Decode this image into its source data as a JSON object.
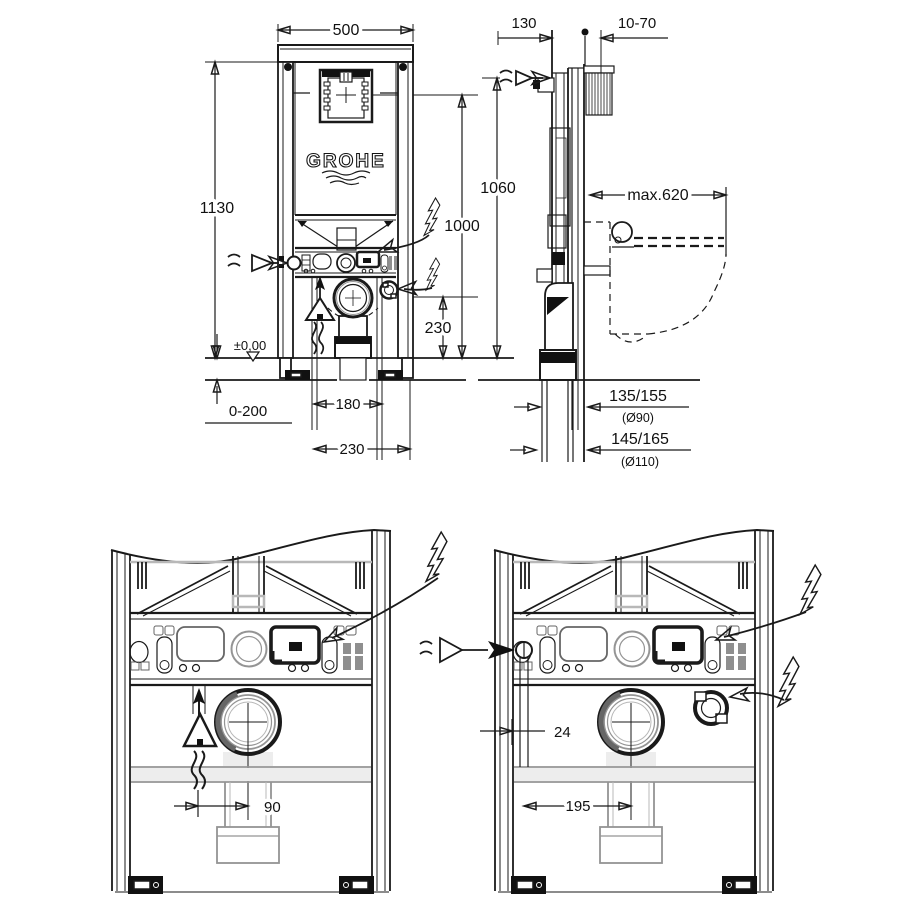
{
  "title": "GROHE concealed WC cistern element - installation dimension drawing",
  "brand": "GROHE",
  "dims": {
    "front_width": "500",
    "front_height": "1130",
    "actuation_height": "1000",
    "outlet_height": "230",
    "floor_level": "±0,00",
    "floor_buildup": "0-200",
    "supply_offset": "180",
    "drain_offset_front": "230",
    "side_depth": "130",
    "wall_range": "10-70",
    "supply_height": "1060",
    "seat_depth": "max.620",
    "drain_90": "135/155",
    "drain_90_dia": "(Ø90)",
    "drain_110": "145/165",
    "drain_110_dia": "(Ø110)",
    "detail_drain_offset": "90",
    "detail_pipe_offset": "24",
    "detail_socket_offset": "195"
  }
}
